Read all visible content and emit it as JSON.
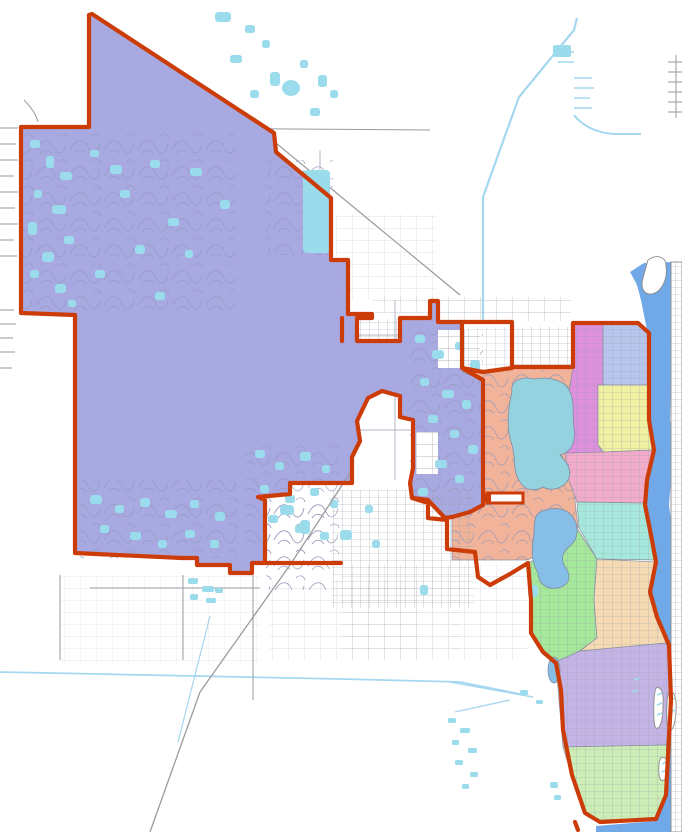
{
  "map": {
    "background": "#ffffff",
    "colors": {
      "boundary": "#cc3c08",
      "district-west": "#a9a9e2",
      "district-salmon": "#f2b39b",
      "district-magenta": "#de8fde",
      "district-periwinkle": "#b7c5ec",
      "district-yellow": "#eff0a2",
      "district-pink": "#f3abcb",
      "district-cyan": "#a6e9dc",
      "district-green": "#a5e79b",
      "district-peach": "#f6dab4",
      "district-lavender": "#c4b4e6",
      "district-lightgreen": "#cdedb6",
      "waterway": "#70a8e8",
      "lake-north": "#95d2df",
      "lake-south": "#86bee8",
      "pond": "#9adcec",
      "canal": "#a5d7f0",
      "road": "#9a9aa0",
      "section-line": "#b4b4c4",
      "island-outline": "#8a8a8a"
    },
    "districts": [
      {
        "id": "district-west",
        "color": "#a9a9e2"
      },
      {
        "id": "district-salmon",
        "color": "#f2b39b"
      },
      {
        "id": "district-magenta",
        "color": "#de8fde"
      },
      {
        "id": "district-periwinkle",
        "color": "#b7c5ec"
      },
      {
        "id": "district-yellow",
        "color": "#eff0a2"
      },
      {
        "id": "district-pink",
        "color": "#f3abcb"
      },
      {
        "id": "district-cyan",
        "color": "#a6e9dc"
      },
      {
        "id": "district-green",
        "color": "#a5e79b"
      },
      {
        "id": "district-peach",
        "color": "#f6dab4"
      },
      {
        "id": "district-lavender",
        "color": "#c4b4e6"
      },
      {
        "id": "district-lightgreen",
        "color": "#cdedb6"
      }
    ]
  }
}
